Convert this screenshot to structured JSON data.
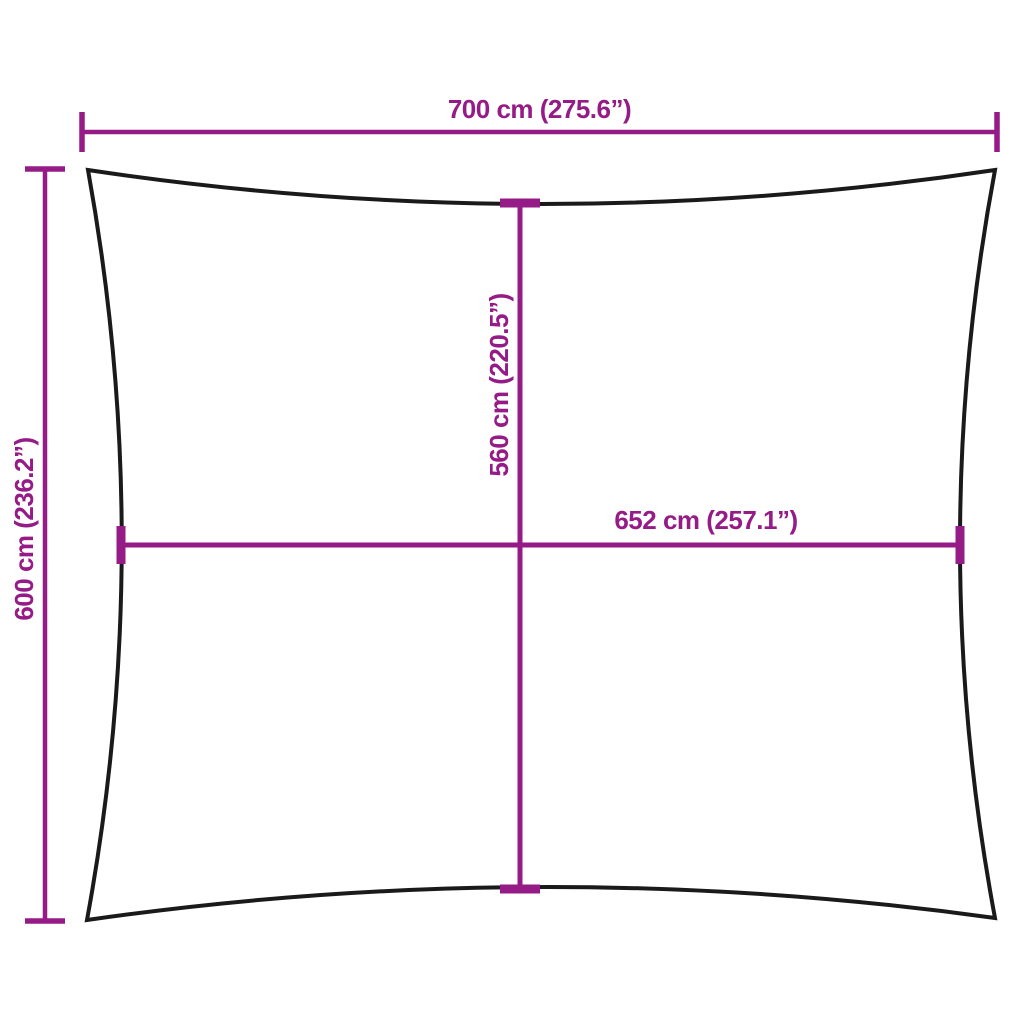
{
  "labels": {
    "top_width": "700 cm (275.6”)",
    "side_height": "600 cm (236.2”)",
    "center_height": "560 cm (220.5”)",
    "center_width": "652 cm (257.1”)"
  },
  "colors": {
    "dimension": "#951b87",
    "outline": "#1a1a1a",
    "background": "#ffffff"
  }
}
